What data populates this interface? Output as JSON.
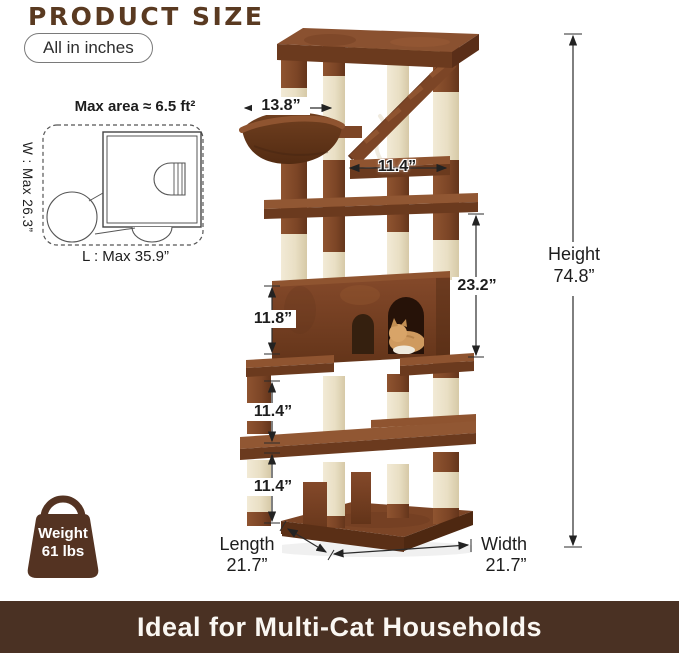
{
  "header": {
    "title": "PRODUCT SIZE",
    "unit_badge": "All in inches"
  },
  "footprint": {
    "title": "Max area ≈ 6.5 ft²",
    "width_label": "W : Max 26.3”",
    "length_label": "L : Max 35.9”"
  },
  "dimensions": {
    "hammock_width": "13.8”",
    "top_perch_width": "11.4”",
    "upper_section_height": "23.2”",
    "condo_height": "11.8”",
    "middle_section_height": "11.4”",
    "lower_section_height": "11.4”",
    "height": {
      "label": "Height",
      "value": "74.8”"
    },
    "length": {
      "label": "Length",
      "value": "21.7”"
    },
    "width": {
      "label": "Width",
      "value": "21.7”"
    }
  },
  "weight_badge": {
    "label": "Weight",
    "value": "61 lbs"
  },
  "banner": {
    "text": "Ideal for Multi-Cat Households"
  },
  "colors": {
    "title_brown": "#5a3a21",
    "banner_bg": "#4a3123",
    "bag_brown": "#543322",
    "plush_brown": "#7c4526",
    "plush_dark": "#5f321b",
    "sisal_cream": "#ece3cb",
    "board_tan": "#d9b88c"
  }
}
